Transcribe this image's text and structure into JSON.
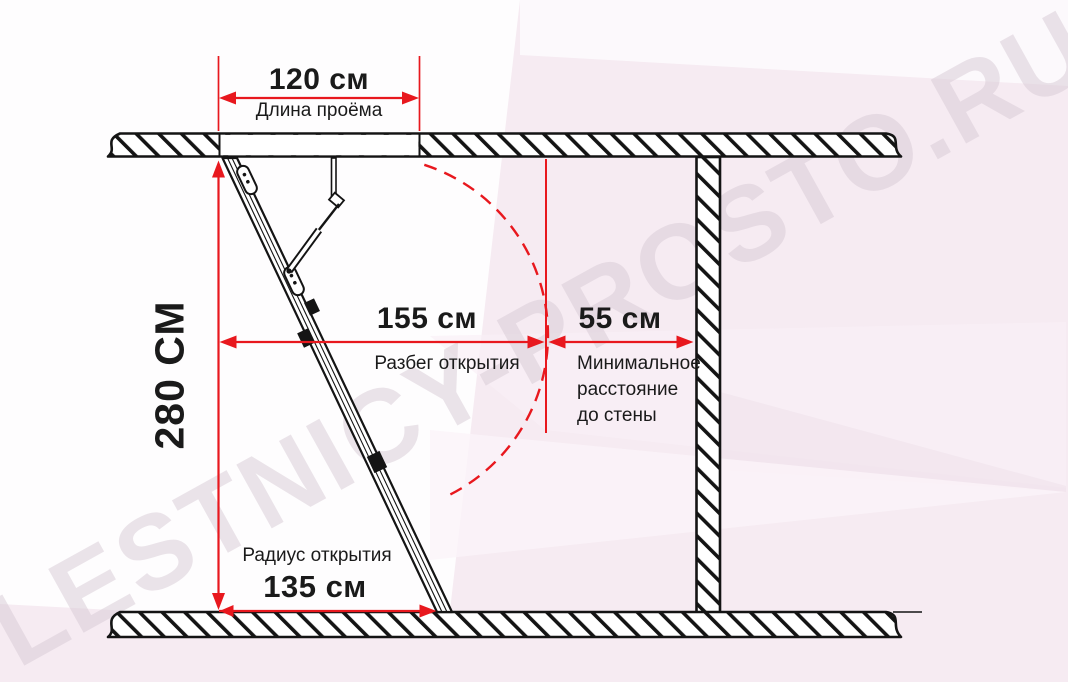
{
  "diagram": {
    "watermark": "LESTNICY-PROSTO.RU",
    "dimensions": {
      "opening_length": {
        "value": "120 см",
        "label": "Длина проёма"
      },
      "ceiling_height": {
        "value": "280 СМ"
      },
      "opening_run": {
        "value": "155 см",
        "label": "Разбег открытия"
      },
      "wall_distance": {
        "value": "55 см",
        "label_lines": [
          "Минимальное",
          "расстояние",
          "до стены"
        ]
      },
      "opening_radius": {
        "value": "135 см",
        "label": "Радиус открытия"
      }
    },
    "colors": {
      "dimension_red": "#e8181e",
      "line_black": "#141414",
      "background_pink": "#f6ebf2",
      "watermark_gray": "#d8cbd5"
    }
  }
}
